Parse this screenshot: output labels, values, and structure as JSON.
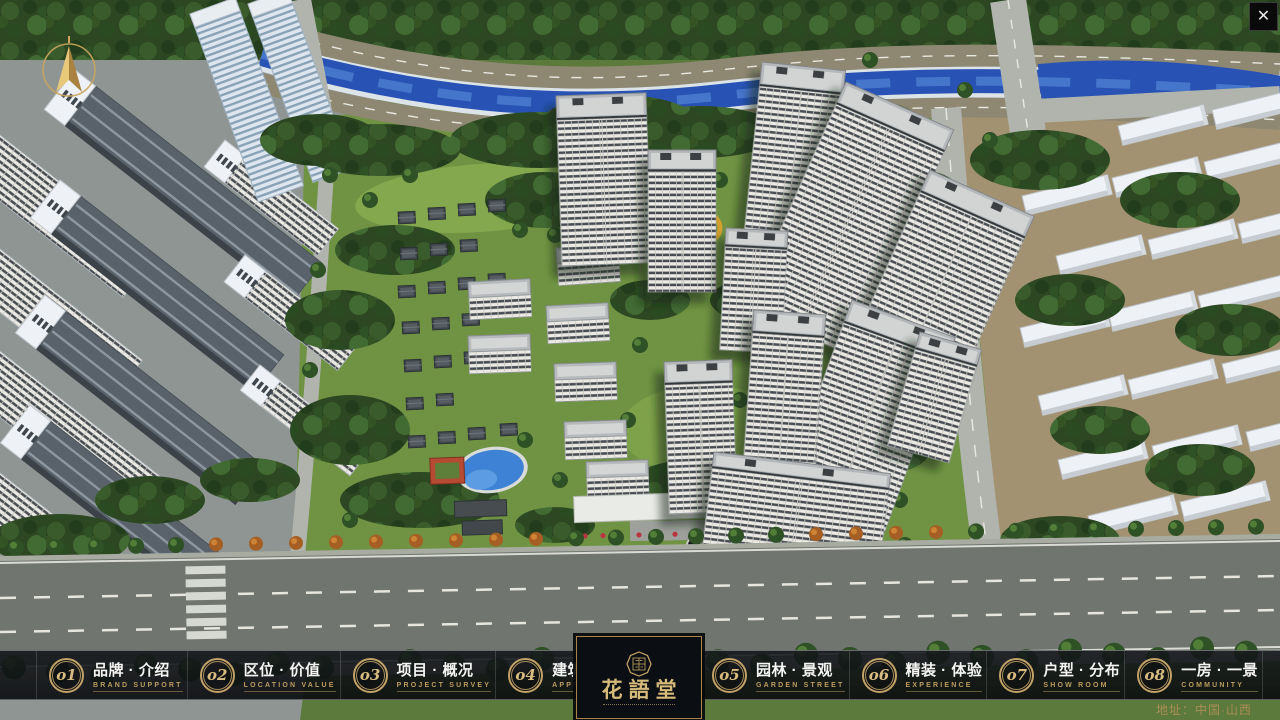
{
  "window": {
    "close_glyph": "✕"
  },
  "colors": {
    "accent_gold": "#c2a267",
    "bar_background": "#10131a",
    "river_blue": "#2853b4"
  },
  "nav": {
    "items": [
      {
        "num": "o1",
        "title": "品牌 · 介绍",
        "subtitle": "BRAND SUPPORT"
      },
      {
        "num": "o2",
        "title": "区位 · 价值",
        "subtitle": "LOCATION VALUE"
      },
      {
        "num": "o3",
        "title": "项目 · 概况",
        "subtitle": "PROJECT SURVEY"
      },
      {
        "num": "o4",
        "title": "建筑 · 鉴赏",
        "subtitle": "APPRECIATION"
      },
      {
        "num": "o5",
        "title": "园林 · 景观",
        "subtitle": "GARDEN STREET"
      },
      {
        "num": "o6",
        "title": "精装 · 体验",
        "subtitle": "EXPERIENCE"
      },
      {
        "num": "o7",
        "title": "户型 · 分布",
        "subtitle": "SHOW ROOM"
      },
      {
        "num": "o8",
        "title": "一房 · 一景",
        "subtitle": "COMMUNITY"
      }
    ]
  },
  "logo": {
    "name": "花語堂"
  },
  "footer": {
    "address": "地址：中国·山西"
  }
}
